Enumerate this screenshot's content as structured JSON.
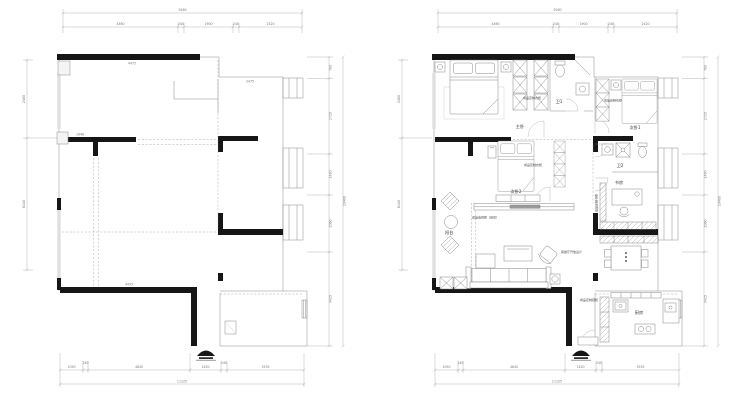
{
  "drawing": {
    "type": "apartment floor plans: original structure (left) and furnished layout (right)",
    "colors": {
      "wall": "#161616",
      "line": "#8c8c8c",
      "dimension": "#9a9a9a",
      "background": "#ffffff"
    },
    "dims": {
      "top_total": "9260",
      "top_segments": [
        "4460",
        "240",
        "1900",
        "240",
        "2420"
      ],
      "bottom_total": "11125",
      "bottom_segments": [
        "1050",
        "240",
        "4640",
        "1420",
        "240",
        "3535"
      ],
      "left_segments": [
        "2480",
        "6140"
      ],
      "right_segments": [
        "780",
        "2725",
        "1490",
        "2060",
        "3425"
      ],
      "right_total": "10480"
    },
    "interior_dims": {
      "d1": "4475",
      "d2": "2475",
      "d3": "1948",
      "d4": "4435"
    },
    "rooms": {
      "master": "主卧",
      "bed2": "次卧1",
      "bed3": "次卧2",
      "study": "书房",
      "bath1": "卫1",
      "bath2": "卫2",
      "kitchen": "厨房",
      "balcony": "阳台"
    },
    "annotations": {
      "wardrobe1": "成品定制衣柜",
      "wardrobe2": "成品定制衣柜",
      "wardrobe3": "成品定制衣柜",
      "bookcase": "成品定制书柜",
      "tv_cabinet": "成品电视柜（悬空）",
      "shoe_cabinet": "成品定制鞋柜",
      "note": "客餐厅开放设计"
    }
  }
}
